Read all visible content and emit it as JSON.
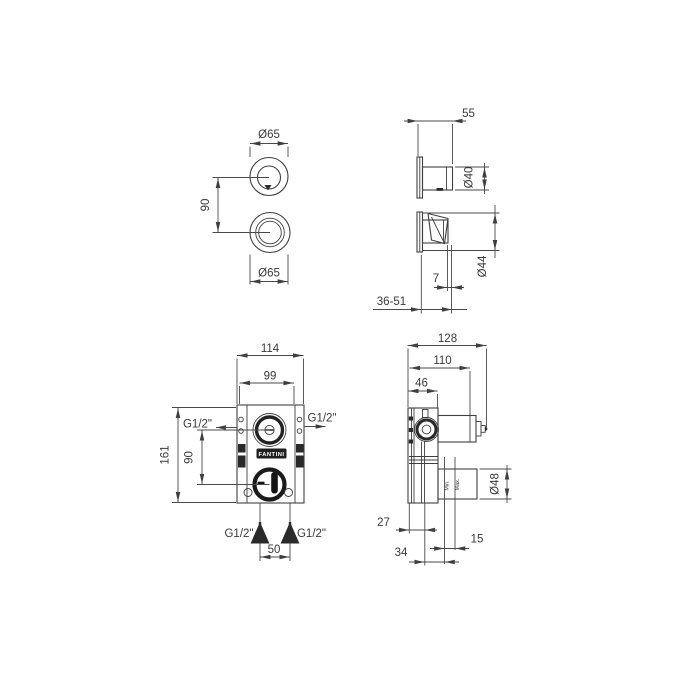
{
  "drawing": {
    "background": "#ffffff",
    "line_color": "#3f3f3f",
    "brand_logo": "FANTINI",
    "views": {
      "handles_front": {
        "top_diameter": "Ø65",
        "bottom_diameter": "Ø65",
        "centers_distance": "90"
      },
      "handles_side": {
        "projection": "55",
        "knob_diameter": "Ø40",
        "lever_diameter": "Ø44",
        "plate_thickness": "7",
        "wall_depth_range": "36-51"
      },
      "valve_front": {
        "overall_width": "114",
        "body_width": "99",
        "overall_height": "161",
        "outlets_distance": "90",
        "inlets_distance": "50",
        "left_connection": "G1/2\"",
        "right_connection": "G1/2\"",
        "bottom_left_connection": "G1/2\"",
        "bottom_right_connection": "G1/2\""
      },
      "valve_side": {
        "overall_depth": "128",
        "mid_depth": "110",
        "body_depth": "46",
        "outlet_diameter": "Ø48",
        "back_offset": "27",
        "mid_offset": "34",
        "front_offset": "15",
        "min_label": "Min.",
        "max_label": "Max."
      }
    }
  }
}
